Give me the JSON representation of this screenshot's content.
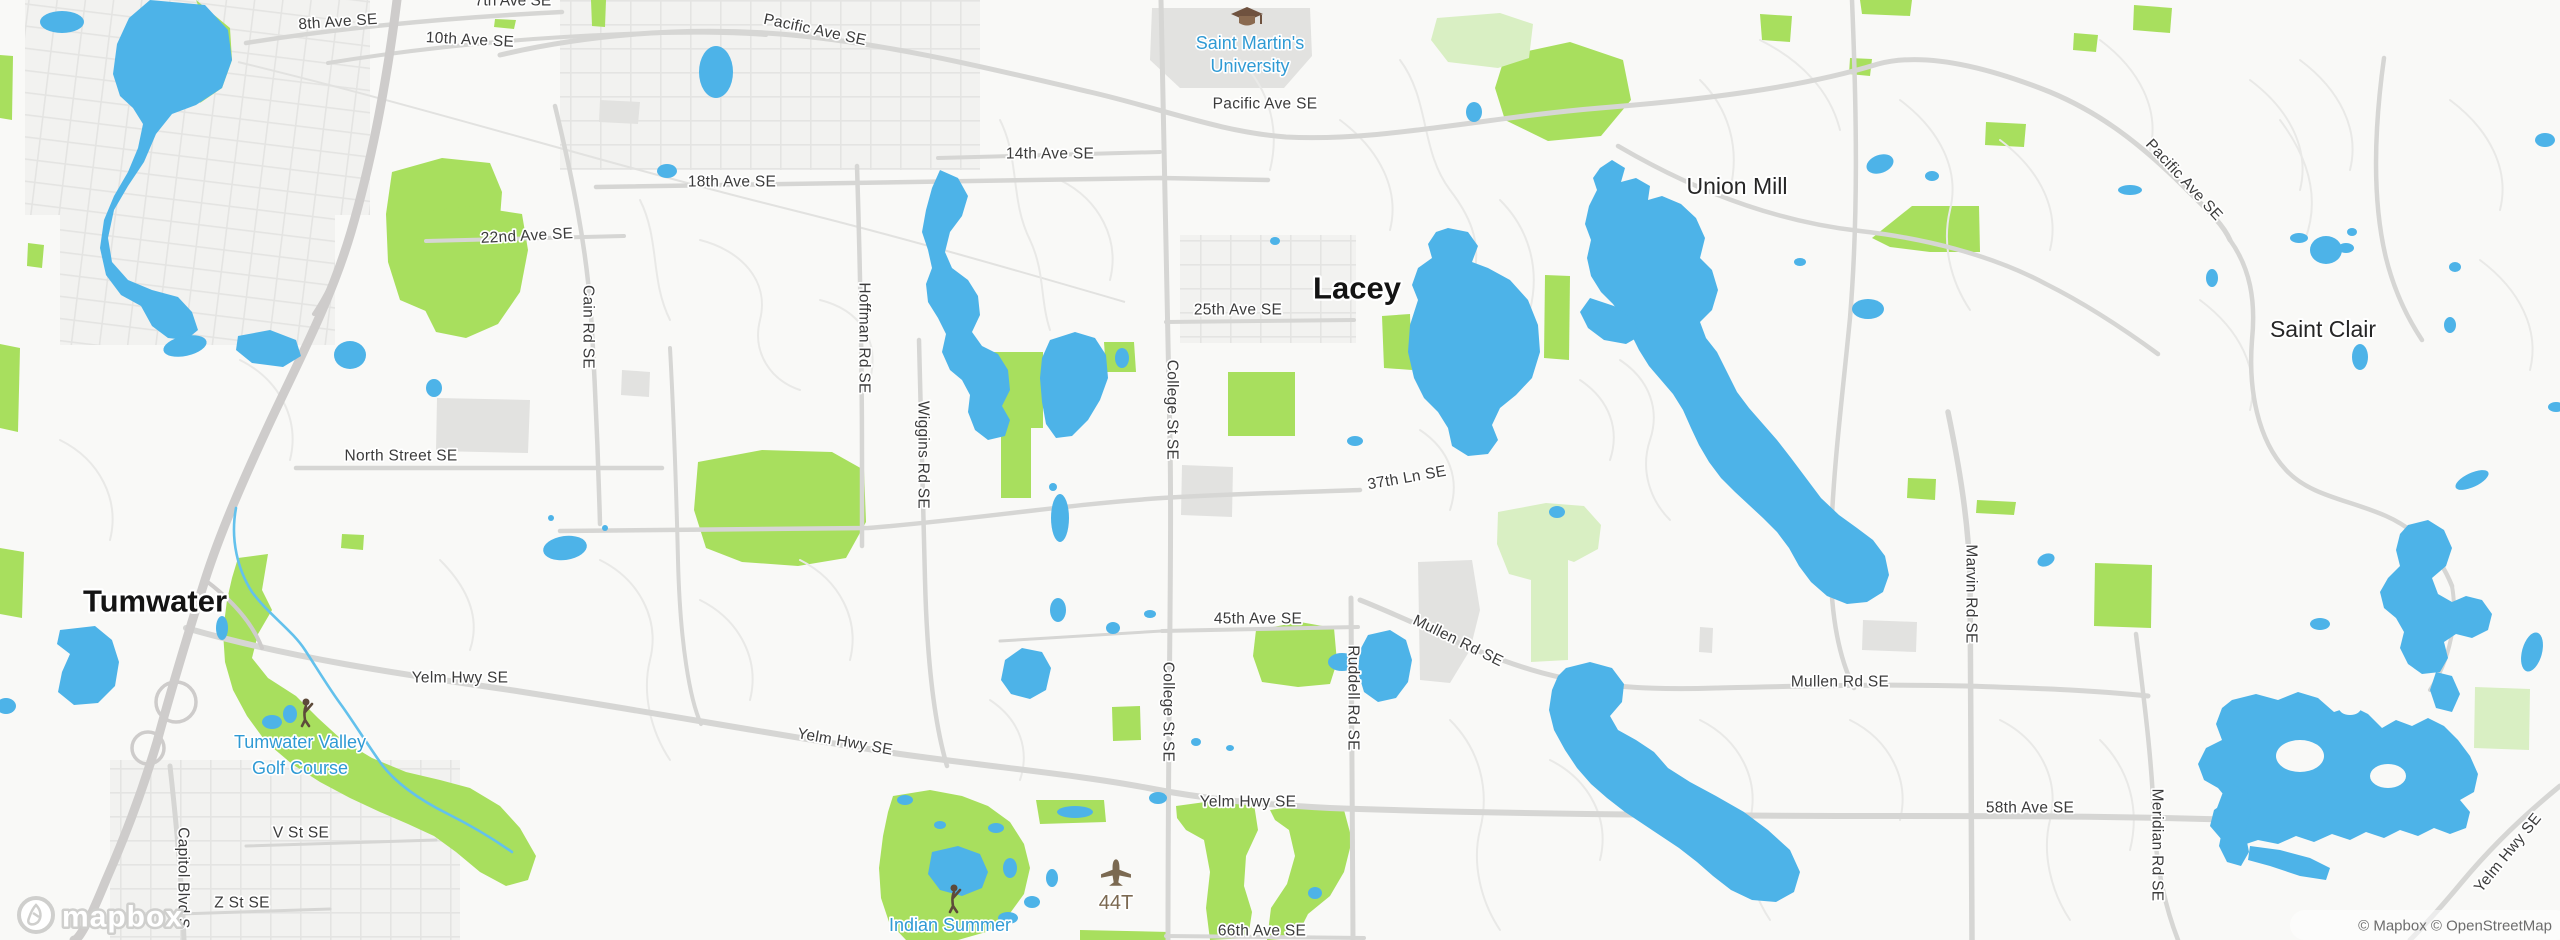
{
  "map": {
    "provider": "mapbox",
    "logo_word": "mapbox",
    "attribution": "© Mapbox © OpenStreetMap",
    "colors": {
      "land": "#f9f9f7",
      "water": "#4db3e8",
      "river": "#63c1ec",
      "park": "#a8df5e",
      "park_pale": "#d9efc3",
      "urban": "#f1f1ef",
      "building": "#e2e2e0",
      "road_minor": "#e9e9e7",
      "road_major": "#d6d6d4",
      "highway": "#cecccb",
      "label_road": "#3b3b3b",
      "label_city": "#141414",
      "label_poi_blue": "#2f9ad4",
      "label_airport": "#7b6951"
    },
    "icons": [
      {
        "id": "graduation-cap-icon",
        "meaning": "university"
      },
      {
        "id": "golfer-icon",
        "meaning": "golf course"
      },
      {
        "id": "airplane-icon",
        "meaning": "airport"
      },
      {
        "id": "mapbox-pin-icon",
        "meaning": "mapbox logo mark"
      }
    ],
    "labels": [
      {
        "id": "seventh-ave-se",
        "text": "7th Ave SE",
        "x": 513,
        "y": 1,
        "rot": 0,
        "cls": "partial"
      },
      {
        "id": "eighth-ave-se",
        "text": "8th Ave SE",
        "x": 338,
        "y": 22,
        "rot": -4,
        "cls": "road"
      },
      {
        "id": "tenth-ave-se",
        "text": "10th Ave SE",
        "x": 470,
        "y": 40,
        "rot": 3,
        "cls": "road"
      },
      {
        "id": "pacific-ave-se-nw",
        "text": "Pacific Ave SE",
        "x": 815,
        "y": 30,
        "rot": 12,
        "cls": "road"
      },
      {
        "id": "pacific-ave-se-center",
        "text": "Pacific Ave SE",
        "x": 1265,
        "y": 104,
        "rot": 0,
        "cls": "road"
      },
      {
        "id": "pacific-ave-se-east",
        "text": "Pacific Ave SE",
        "x": 2184,
        "y": 180,
        "rot": 47,
        "cls": "road"
      },
      {
        "id": "fourteenth-ave-se",
        "text": "14th Ave SE",
        "x": 1050,
        "y": 154,
        "rot": 0,
        "cls": "road"
      },
      {
        "id": "eighteenth-ave-se",
        "text": "18th Ave SE",
        "x": 732,
        "y": 182,
        "rot": 0,
        "cls": "road"
      },
      {
        "id": "twentysecond-ave-se",
        "text": "22nd Ave SE",
        "x": 527,
        "y": 236,
        "rot": -3,
        "cls": "road"
      },
      {
        "id": "twentyfifth-ave-se",
        "text": "25th Ave SE",
        "x": 1238,
        "y": 310,
        "rot": 0,
        "cls": "road"
      },
      {
        "id": "north-street-se",
        "text": "North Street SE",
        "x": 401,
        "y": 456,
        "rot": 0,
        "cls": "road"
      },
      {
        "id": "thirtyseventh-ln-se",
        "text": "37th Ln SE",
        "x": 1407,
        "y": 478,
        "rot": -10,
        "cls": "road"
      },
      {
        "id": "fortyfifth-ave-se",
        "text": "45th Ave SE",
        "x": 1258,
        "y": 619,
        "rot": 0,
        "cls": "road"
      },
      {
        "id": "yelm-hwy-se-west",
        "text": "Yelm Hwy SE",
        "x": 460,
        "y": 678,
        "rot": 0,
        "cls": "road"
      },
      {
        "id": "yelm-hwy-se-mid",
        "text": "Yelm Hwy SE",
        "x": 845,
        "y": 742,
        "rot": 10,
        "cls": "road"
      },
      {
        "id": "yelm-hwy-se-center",
        "text": "Yelm Hwy SE",
        "x": 1248,
        "y": 802,
        "rot": 0,
        "cls": "road"
      },
      {
        "id": "yelm-hwy-se-east",
        "text": "Yelm Hwy SE",
        "x": 2508,
        "y": 853,
        "rot": -51,
        "cls": "road"
      },
      {
        "id": "mullen-rd-se-diag",
        "text": "Mullen Rd SE",
        "x": 1458,
        "y": 641,
        "rot": 26,
        "cls": "road"
      },
      {
        "id": "mullen-rd-se-east",
        "text": "Mullen Rd SE",
        "x": 1840,
        "y": 682,
        "rot": 0,
        "cls": "road"
      },
      {
        "id": "fiftyeighth-ave-se",
        "text": "58th Ave SE",
        "x": 2030,
        "y": 808,
        "rot": 0,
        "cls": "road"
      },
      {
        "id": "sixtysixth-ave-se",
        "text": "66th Ave SE",
        "x": 1262,
        "y": 931,
        "rot": 0,
        "cls": "road"
      },
      {
        "id": "v-st-se",
        "text": "V St SE",
        "x": 301,
        "y": 833,
        "rot": 0,
        "cls": "road"
      },
      {
        "id": "z-st-se",
        "text": "Z St SE",
        "x": 242,
        "y": 903,
        "rot": 0,
        "cls": "road"
      },
      {
        "id": "cain-rd-se",
        "text": "Cain Rd SE",
        "x": 588,
        "y": 327,
        "rot": 90,
        "cls": "road"
      },
      {
        "id": "hoffman-rd-se",
        "text": "Hoffman Rd SE",
        "x": 864,
        "y": 338,
        "rot": 90,
        "cls": "road"
      },
      {
        "id": "wiggins-rd-se",
        "text": "Wiggins Rd SE",
        "x": 923,
        "y": 455,
        "rot": 90,
        "cls": "road"
      },
      {
        "id": "college-st-se-north",
        "text": "College St SE",
        "x": 1172,
        "y": 410,
        "rot": 90,
        "cls": "road"
      },
      {
        "id": "college-st-se-south",
        "text": "College St SE",
        "x": 1168,
        "y": 712,
        "rot": 90,
        "cls": "road"
      },
      {
        "id": "ruddell-rd-se",
        "text": "Ruddell Rd SE",
        "x": 1353,
        "y": 698,
        "rot": 90,
        "cls": "road"
      },
      {
        "id": "marvin-rd-se",
        "text": "Marvin Rd SE",
        "x": 1971,
        "y": 594,
        "rot": 90,
        "cls": "road"
      },
      {
        "id": "meridian-rd-se",
        "text": "Meridian Rd SE",
        "x": 2157,
        "y": 845,
        "rot": 90,
        "cls": "road"
      },
      {
        "id": "capitol-blvd-s",
        "text": "Capitol Blvd S",
        "x": 183,
        "y": 878,
        "rot": 90,
        "cls": "road"
      },
      {
        "id": "lacey",
        "text": "Lacey",
        "x": 1357,
        "y": 288,
        "rot": 0,
        "cls": "city"
      },
      {
        "id": "tumwater",
        "text": "Tumwater",
        "x": 155,
        "y": 601,
        "rot": 0,
        "cls": "city"
      },
      {
        "id": "union-mill",
        "text": "Union Mill",
        "x": 1737,
        "y": 186,
        "rot": 0,
        "cls": "town"
      },
      {
        "id": "saint-clair",
        "text": "Saint Clair",
        "x": 2323,
        "y": 329,
        "rot": 0,
        "cls": "town"
      },
      {
        "id": "saint-martins-university",
        "lines": [
          "Saint Martin's",
          "University"
        ],
        "x": 1250,
        "y": 43,
        "lh": 23,
        "rot": 0,
        "cls": "poi"
      },
      {
        "id": "tumwater-valley-golf-course",
        "lines": [
          "Tumwater Valley",
          "Golf Course"
        ],
        "x": 300,
        "y": 742,
        "lh": 26,
        "rot": 0,
        "cls": "poi"
      },
      {
        "id": "indian-summer",
        "text": "Indian Summer",
        "x": 950,
        "y": 925,
        "rot": 0,
        "cls": "poi"
      },
      {
        "id": "airport-44t",
        "text": "44T",
        "x": 1116,
        "y": 903,
        "rot": 0,
        "cls": "airport"
      }
    ]
  }
}
